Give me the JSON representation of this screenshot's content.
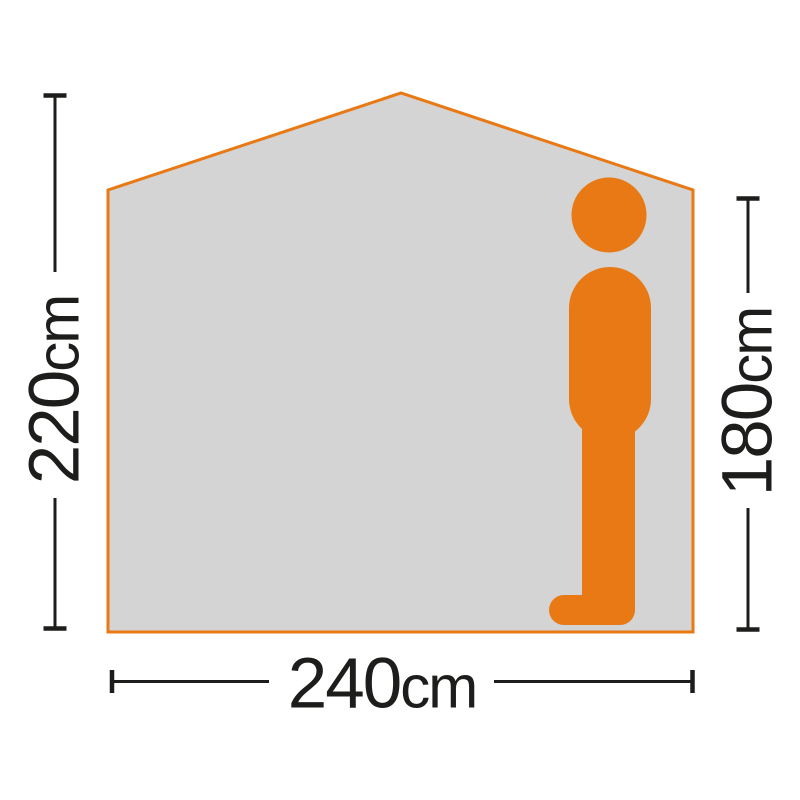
{
  "colors": {
    "background": "#FFFFFF",
    "accent_orange": "#E87914",
    "panel_gray": "#D4D4D4",
    "ink": "#1D1D1B"
  },
  "figures": {
    "tent": "tent-side-profile-shape",
    "person": "standing-person-silhouette"
  },
  "dimensions": {
    "tent_height": {
      "value": "220",
      "unit": "cm"
    },
    "person_height": {
      "value": "180",
      "unit": "cm"
    },
    "tent_width": {
      "value": "240",
      "unit": "cm"
    }
  }
}
